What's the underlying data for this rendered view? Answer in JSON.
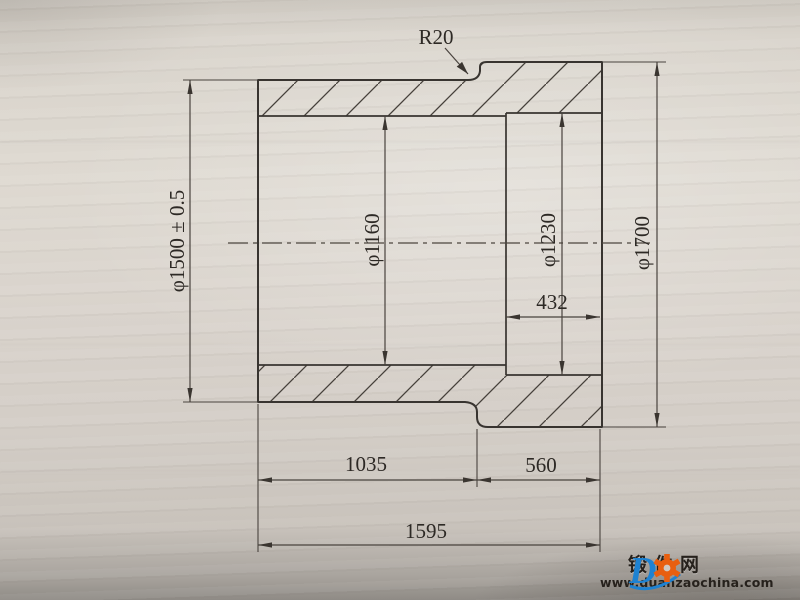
{
  "drawing": {
    "fillet_radius": "R20",
    "outer_diameter_left": "φ1500 ± 0.5",
    "bore_diameter_left": "φ1160",
    "bore_diameter_right": "φ1230",
    "outer_diameter_right": "φ1700",
    "bore_depth_right": "432",
    "length_left_section": "1035",
    "length_right_section": "560",
    "length_total": "1595"
  },
  "watermark": {
    "site_name": "锻件网",
    "site_url": "www.duanzaochina.com",
    "logo_letter": "D"
  },
  "colors": {
    "ink": "#383430",
    "paper": "#d9d4cc",
    "logo_blue": "#1e82d2",
    "logo_orange": "#e85f0f"
  }
}
